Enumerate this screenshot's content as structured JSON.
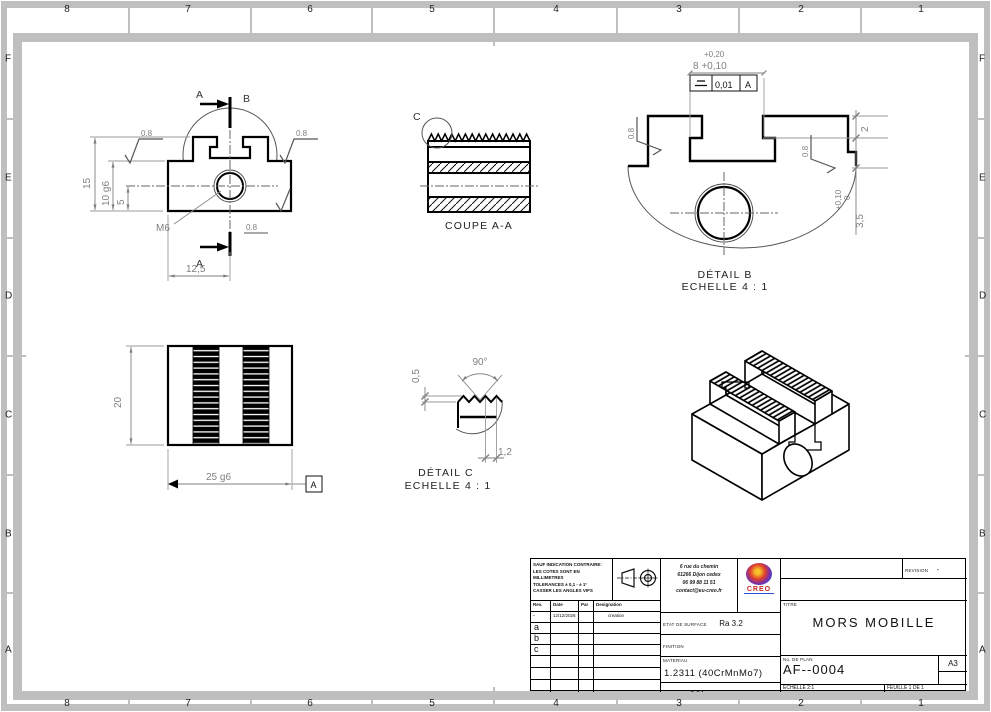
{
  "sheet": {
    "zone_numbers": [
      "8",
      "7",
      "6",
      "5",
      "4",
      "3",
      "2",
      "1"
    ],
    "zone_letters": [
      "F",
      "E",
      "D",
      "C",
      "B",
      "A"
    ]
  },
  "views": {
    "front": {
      "section_arrow_top": "A",
      "section_arrow_bottom": "A",
      "detail_circle": "B",
      "dim_total_height": "15",
      "dim_fit_height": "10 g6",
      "dim_hole_height": "5",
      "dim_width": "12,5",
      "thread_callout": "M6",
      "roughness": "0.8"
    },
    "coupe": {
      "title": "COUPE A-A",
      "detail_circle": "C"
    },
    "detail_b": {
      "title": "DÉTAIL B",
      "scale": "ECHELLE 4 : 1",
      "tol_line1": "+0,20",
      "dim_line2": "8 +0,10",
      "fcf_value": "0,01",
      "fcf_datum": "A",
      "dim_step": "2",
      "dim_depth": "3,5",
      "dim_depth_tol_upper": "+0,10",
      "dim_depth_tol_lower": "0",
      "roughness": "0.8"
    },
    "top": {
      "dim_height": "20",
      "dim_width": "25 g6",
      "datum": "A"
    },
    "detail_c": {
      "title": "DÉTAIL C",
      "scale": "ECHELLE 4 : 1",
      "dim_angle": "90°",
      "dim_tooth_depth": "0,5",
      "dim_pitch": "1,2"
    }
  },
  "titleblock": {
    "notes": [
      "SAUF INDICATION CONTRAIRE:",
      "LES COTES SONT EN MILLIMETRES",
      "TOLERANCES ± 0,1 - ± 1°",
      "CASSER LES ANGLES VIFS"
    ],
    "company": [
      "6 rue du chemin",
      "61266 Dijon cedex",
      "06 99 88 11 51",
      "contact@eu-creo.fr"
    ],
    "logo_text": "CREO",
    "rev_headers": [
      "Rev.",
      "Date",
      "Par",
      "Designation"
    ],
    "rev_rows": [
      {
        "rev": "-",
        "date": "12/12/2026",
        "par": "",
        "designation": "creation"
      },
      {
        "rev": "a"
      },
      {
        "rev": "b"
      },
      {
        "rev": "c"
      }
    ],
    "surface_label": "ETAT DE SURFACE",
    "surface_value": "Ra 3.2",
    "finish_label": "FINITION",
    "finish_value": "BRUNISSAGE",
    "material_label": "MATERIAU",
    "material_value": "1.2311 (40CrMnMo7)",
    "mass_label": "MASSE",
    "mass_value": "0.04",
    "revision_label": "REVISION",
    "revision_value": "-",
    "title_label": "TITRE",
    "title_value": "MORS MOBILLE",
    "plan_label": "No. DE PLAN",
    "plan_value": "AF--0004",
    "format": "A3",
    "scale_text": "ECHELLE 2:1",
    "sheet_text": "FEUILLE 1 DE 1"
  },
  "colors": {
    "frame_gray": "#bfbfbf",
    "dim_gray": "#7f7f7f",
    "line_black": "#1a1a1a",
    "logo_red": "#c52a24"
  }
}
